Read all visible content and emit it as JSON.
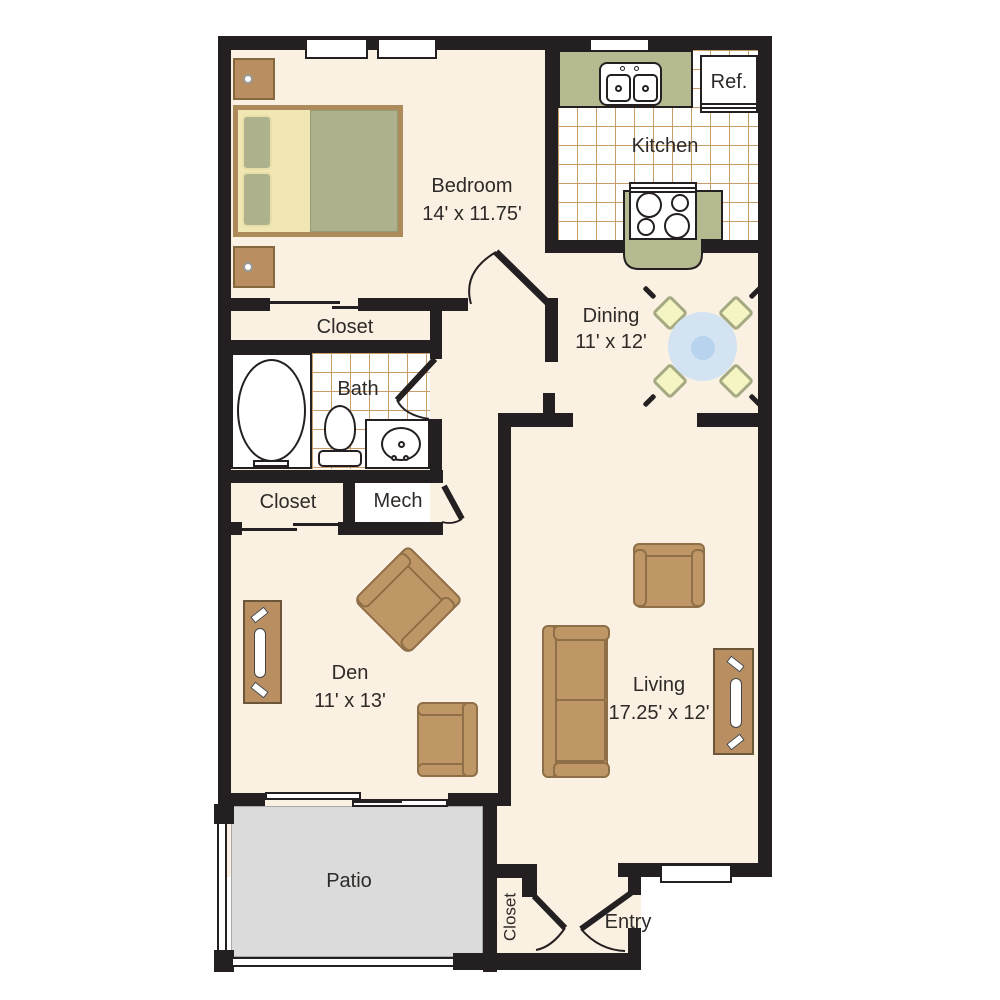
{
  "rooms": {
    "bedroom": {
      "label": "Bedroom",
      "dims": "14' x 11.75'"
    },
    "kitchen": {
      "label": "Kitchen"
    },
    "ref": {
      "label": "Ref."
    },
    "dining": {
      "label": "Dining",
      "dims": "11' x 12'"
    },
    "closet_bedroom": {
      "label": "Closet"
    },
    "bath": {
      "label": "Bath"
    },
    "closet_hall": {
      "label": "Closet"
    },
    "mech": {
      "label": "Mech"
    },
    "den": {
      "label": "Den",
      "dims": "11' x 13'"
    },
    "living": {
      "label": "Living",
      "dims": "17.25' x 12'"
    },
    "patio": {
      "label": "Patio"
    },
    "closet_entry": {
      "label": "Closet"
    },
    "entry": {
      "label": "Entry"
    }
  },
  "colors": {
    "wall": "#241f21",
    "floor": "#fbf1e2",
    "tile_line": "#c89d6a",
    "counter_green": "#b5ba90",
    "furniture_tan": "#bf9666",
    "furniture_border": "#8f6f47",
    "wood": "#b98e60",
    "bed_blanket": "#aeb28c",
    "bed_sheet": "#f0e7b4",
    "chair_yellow": "#f4f5c3",
    "chair_sage": "#a6aa82",
    "table_outer_blue": "#d3e3f1",
    "table_inner_blue": "#b7d3ee",
    "patio_gray": "#dbdbdb"
  }
}
